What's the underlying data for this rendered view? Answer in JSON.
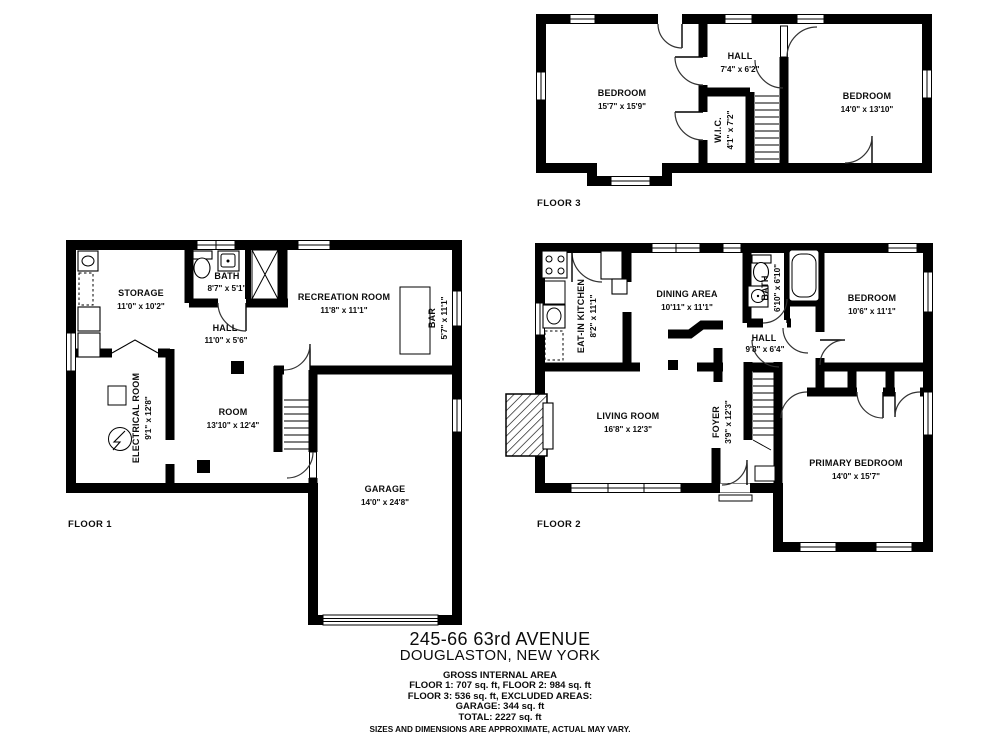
{
  "colors": {
    "wall": "#000000",
    "background": "#ffffff",
    "text": "#0c0c0c"
  },
  "f1": {
    "label": "FLOOR 1",
    "storage": {
      "name": "STORAGE",
      "dims": "11'0\" x 10'2\""
    },
    "bath": {
      "name": "BATH",
      "dims": "8'7\" x 5'1\""
    },
    "hall": {
      "name": "HALL",
      "dims": "11'0\" x 5'6\""
    },
    "recreation": {
      "name": "RECREATION ROOM",
      "dims": "11'8\" x 11'1\""
    },
    "bar": {
      "name": "BAR",
      "dims": "5'7\" x 11'1\""
    },
    "electrical": {
      "name": "ELECTRICAL ROOM",
      "dims": "9'1\" x 12'8\""
    },
    "room": {
      "name": "ROOM",
      "dims": "13'10\" x 12'4\""
    },
    "garage": {
      "name": "GARAGE",
      "dims": "14'0\" x 24'8\""
    }
  },
  "f2": {
    "label": "FLOOR 2",
    "kitchen": {
      "name": "EAT-IN KITCHEN",
      "dims": "8'2\" x 11'1\""
    },
    "dining": {
      "name": "DINING AREA",
      "dims": "10'11\" x 11'1\""
    },
    "bath": {
      "name": "BATH",
      "dims": "6'10\" x 6'10\""
    },
    "bedroom": {
      "name": "BEDROOM",
      "dims": "10'6\" x 11'1\""
    },
    "hall": {
      "name": "HALL",
      "dims": "9'8\" x 6'4\""
    },
    "living": {
      "name": "LIVING ROOM",
      "dims": "16'8\" x 12'3\""
    },
    "foyer": {
      "name": "FOYER",
      "dims": "3'9\" x 12'3\""
    },
    "primary": {
      "name": "PRIMARY BEDROOM",
      "dims": "14'0\" x 15'7\""
    }
  },
  "f3": {
    "label": "FLOOR 3",
    "bedroom1": {
      "name": "BEDROOM",
      "dims": "15'7\" x 15'9\""
    },
    "hall": {
      "name": "HALL",
      "dims": "7'4\" x 6'2\""
    },
    "wic": {
      "name": "W.I.C.",
      "dims": "4'1\" x 7'2\""
    },
    "bedroom2": {
      "name": "BEDROOM",
      "dims": "14'0\" x 13'10\""
    }
  },
  "title_block": {
    "address_line1": "245-66 63rd AVENUE",
    "address_line2": "DOUGLASTON, NEW YORK",
    "area_heading": "GROSS INTERNAL AREA",
    "area_lines": [
      "FLOOR 1: 707 sq. ft, FLOOR 2: 984 sq. ft",
      "FLOOR 3: 536 sq. ft, EXCLUDED AREAS:",
      "GARAGE: 344 sq. ft",
      "TOTAL: 2227 sq. ft"
    ],
    "disclaimer": "SIZES AND DIMENSIONS ARE APPROXIMATE, ACTUAL MAY VARY."
  }
}
